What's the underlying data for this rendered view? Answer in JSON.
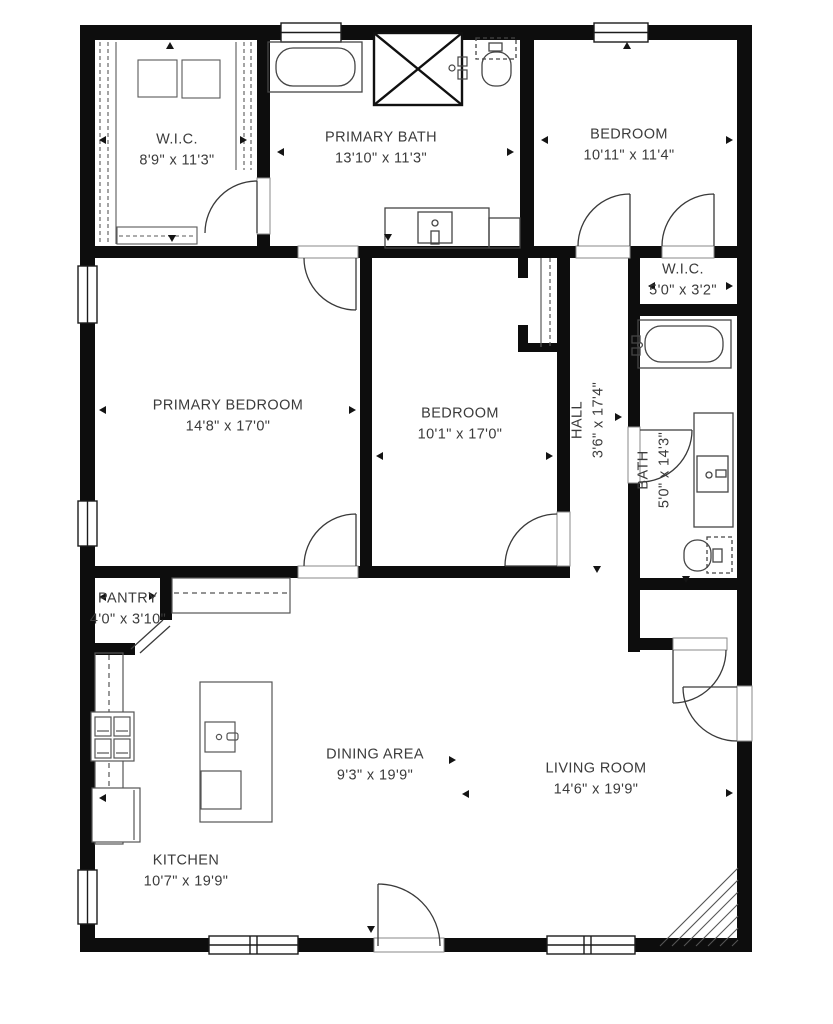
{
  "plan": {
    "type": "residential-floor-plan",
    "wall_color": "#0d0d0d",
    "fixture_line_color": "#4a4a4a",
    "label_color": "#3b3b3b",
    "background": "#ffffff"
  },
  "rooms": [
    {
      "id": "wic-primary",
      "name": "W.I.C.",
      "dims": "8'9\" x 11'3\""
    },
    {
      "id": "primary-bath",
      "name": "PRIMARY BATH",
      "dims": "13'10\" x 11'3\""
    },
    {
      "id": "bedroom-top",
      "name": "BEDROOM",
      "dims": "10'11\" x 11'4\""
    },
    {
      "id": "primary-bedroom",
      "name": "PRIMARY BEDROOM",
      "dims": "14'8\" x 17'0\""
    },
    {
      "id": "bedroom-middle",
      "name": "BEDROOM",
      "dims": "10'1\" x 17'0\""
    },
    {
      "id": "hall",
      "name": "HALL",
      "dims": "3'6\" x 17'4\""
    },
    {
      "id": "wic-hall",
      "name": "W.I.C.",
      "dims": "5'0\" x 3'2\""
    },
    {
      "id": "bath",
      "name": "BATH",
      "dims": "5'0\" x 14'3\""
    },
    {
      "id": "pantry",
      "name": "PANTRY",
      "dims": "4'0\" x 3'10\""
    },
    {
      "id": "kitchen",
      "name": "KITCHEN",
      "dims": "10'7\" x 19'9\""
    },
    {
      "id": "dining-area",
      "name": "DINING AREA",
      "dims": "9'3\" x 19'9\""
    },
    {
      "id": "living-room",
      "name": "LIVING ROOM",
      "dims": "14'6\" x 19'9\""
    }
  ],
  "fixtures": [
    "bathtub-primary",
    "shower",
    "toilet-primary",
    "vanity-sink-primary",
    "dresser",
    "closet-rods",
    "shoe-rack",
    "bathtub-hall",
    "vanity-sink-hall",
    "toilet-hall",
    "sliding-closet-door",
    "kitchen-counter",
    "cooktop",
    "refrigerator",
    "kitchen-island",
    "island-sink",
    "dishwasher",
    "stairs-hatch",
    "windows",
    "doors"
  ]
}
